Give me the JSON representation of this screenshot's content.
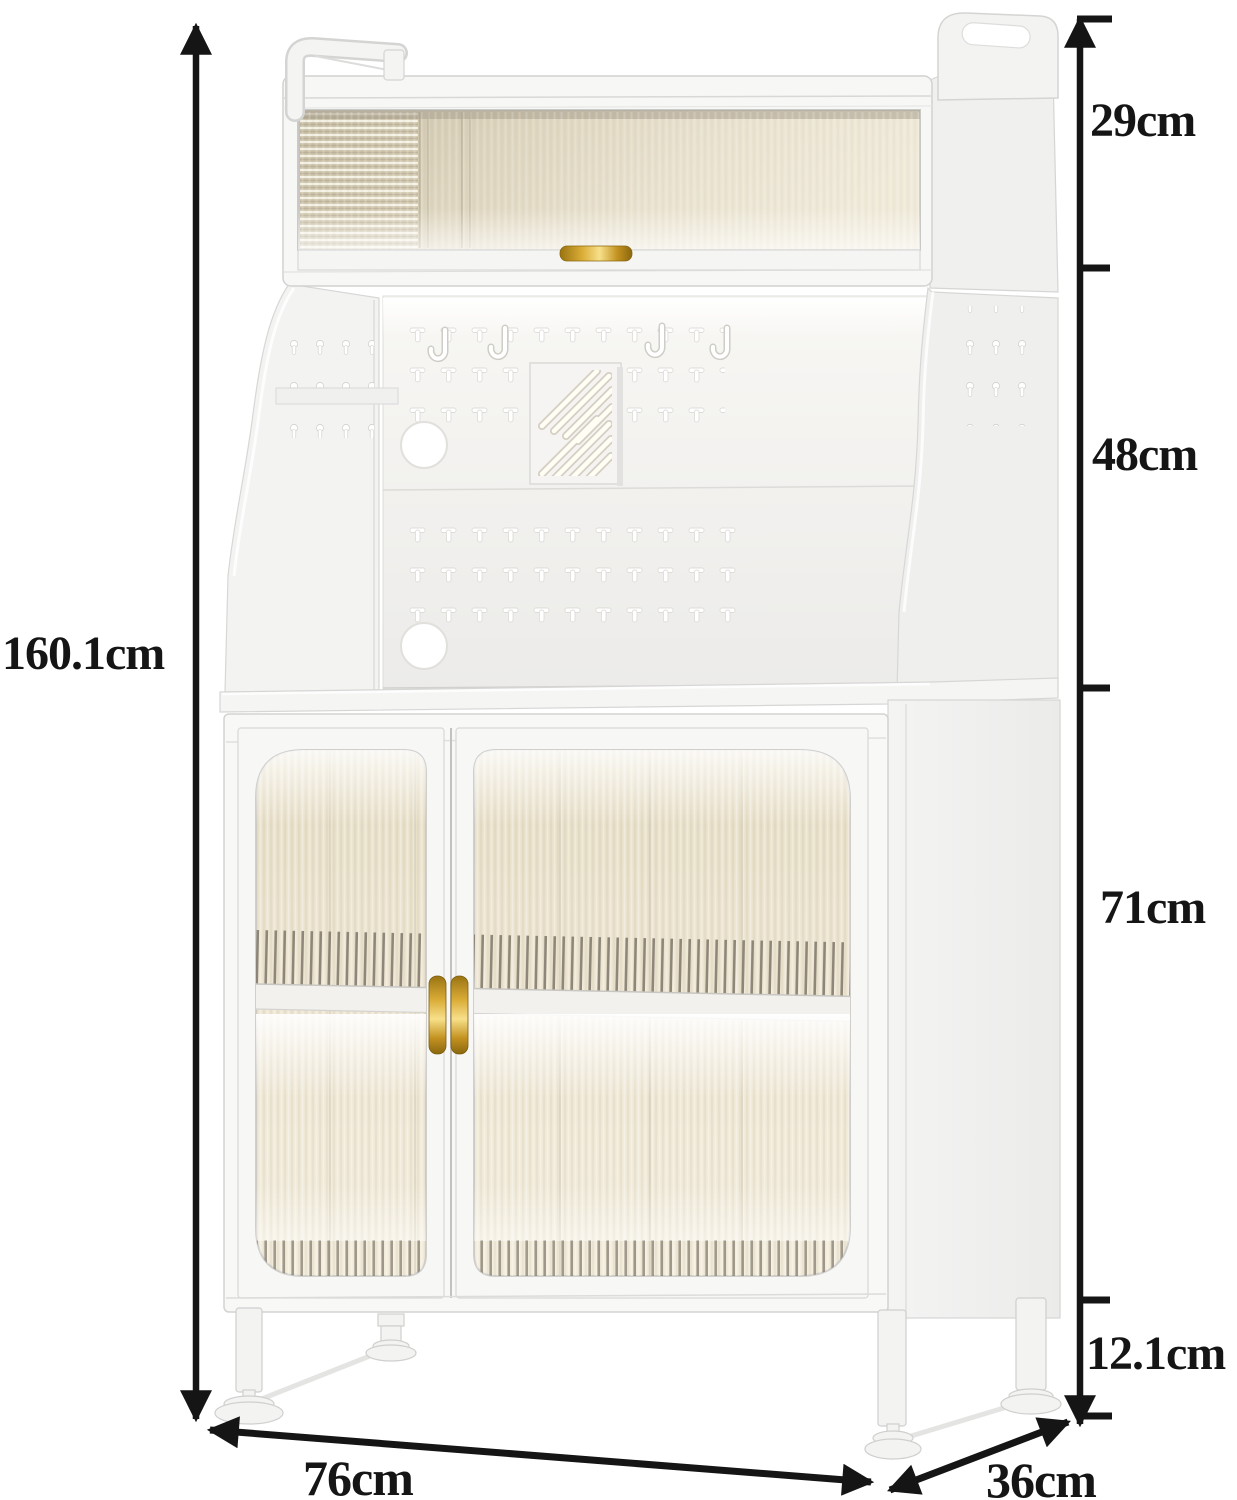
{
  "diagram": {
    "subject": "storage cabinet dimension drawing",
    "unit": "cm",
    "labels": {
      "total_height": "160.1cm",
      "hutch_height": "29cm",
      "pegboard_height": "48cm",
      "cabinet_height": "71cm",
      "leg_height": "12.1cm",
      "width": "76cm",
      "depth": "36cm"
    },
    "colors": {
      "dimension_line": "#151515",
      "label_text": "#151515",
      "cabinet_body": "#f6f6f5",
      "cabinet_outline": "#d3d3d2",
      "glass_tint": "#e8dfc8",
      "gold_accent": "#d9ab35",
      "background": "#ffffff"
    }
  }
}
